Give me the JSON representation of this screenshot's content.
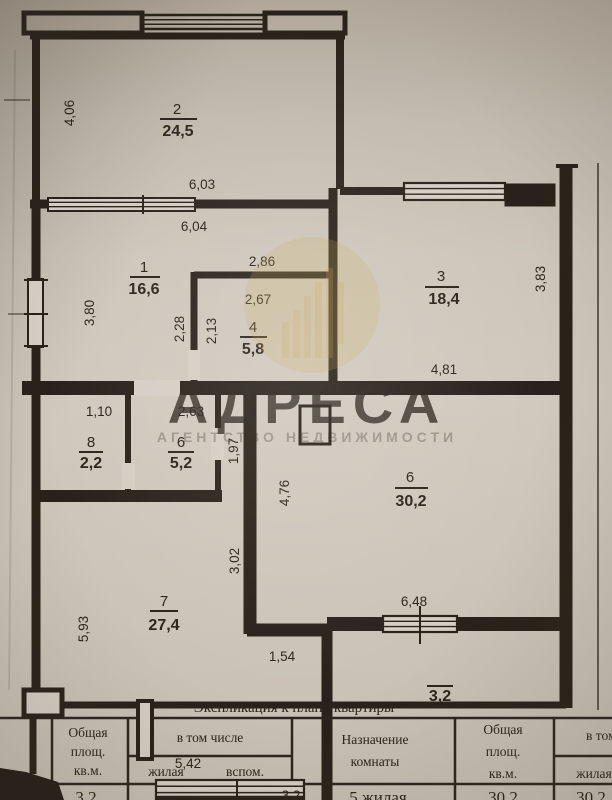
{
  "watermark": {
    "brand": "АДРЕСА",
    "subtitle": "АГЕНТСТВО НЕДВИЖИМОСТИ",
    "color": "#c7a43f"
  },
  "plan": {
    "rooms": {
      "r2": {
        "number": "2",
        "area": "24,5"
      },
      "r1": {
        "number": "1",
        "area": "16,6"
      },
      "r3": {
        "number": "3",
        "area": "18,4"
      },
      "r4": {
        "number": "4",
        "area": "5,8"
      },
      "r8": {
        "number": "8",
        "area": "2,2"
      },
      "r6s": {
        "number": "6",
        "area": "5,2"
      },
      "r6b": {
        "number": "6",
        "area": "30,2"
      },
      "r7": {
        "number": "7",
        "area": "27,4"
      },
      "balcony": {
        "area": "3,2"
      },
      "loggia_low": {
        "area": "3,2"
      }
    },
    "dimensions": {
      "top_height": "4,06",
      "top_width": "6,03",
      "r1_width": "6,04",
      "r4_outer_width": "2,86",
      "r4_width": "2,67",
      "r1_height": "3,80",
      "r1_right_height": "2,28",
      "r4_height": "2,13",
      "r3_height": "3,83",
      "r3_width": "4,81",
      "r8_width": "1,10",
      "r6s_width": "2,63",
      "r6s_height": "1,97",
      "r6b_height": "4,76",
      "hall_height": "3,02",
      "r7_height": "5,93",
      "r6b_width": "6,48",
      "opening_width": "1,54",
      "loggia_width": "5,42"
    }
  },
  "table": {
    "title": "Экспликация к плану квартиры",
    "left": {
      "total_l1": "Общая",
      "total_l2": "площ.",
      "total_l3": "кв.м.",
      "group": "в том числе",
      "living": "жилая",
      "aux": "вспом.",
      "purpose_l1": "Назначение",
      "purpose_l2": "комнаты"
    },
    "right": {
      "total_l1": "Общая",
      "total_l2": "площ.",
      "total_l3": "кв.м.",
      "group": "в том числе",
      "living": "жилая"
    },
    "row": {
      "total": "3,2",
      "aux": "3,2",
      "purpose": "5 жилая",
      "total_right": "30,2",
      "living_right": "30,2"
    }
  }
}
